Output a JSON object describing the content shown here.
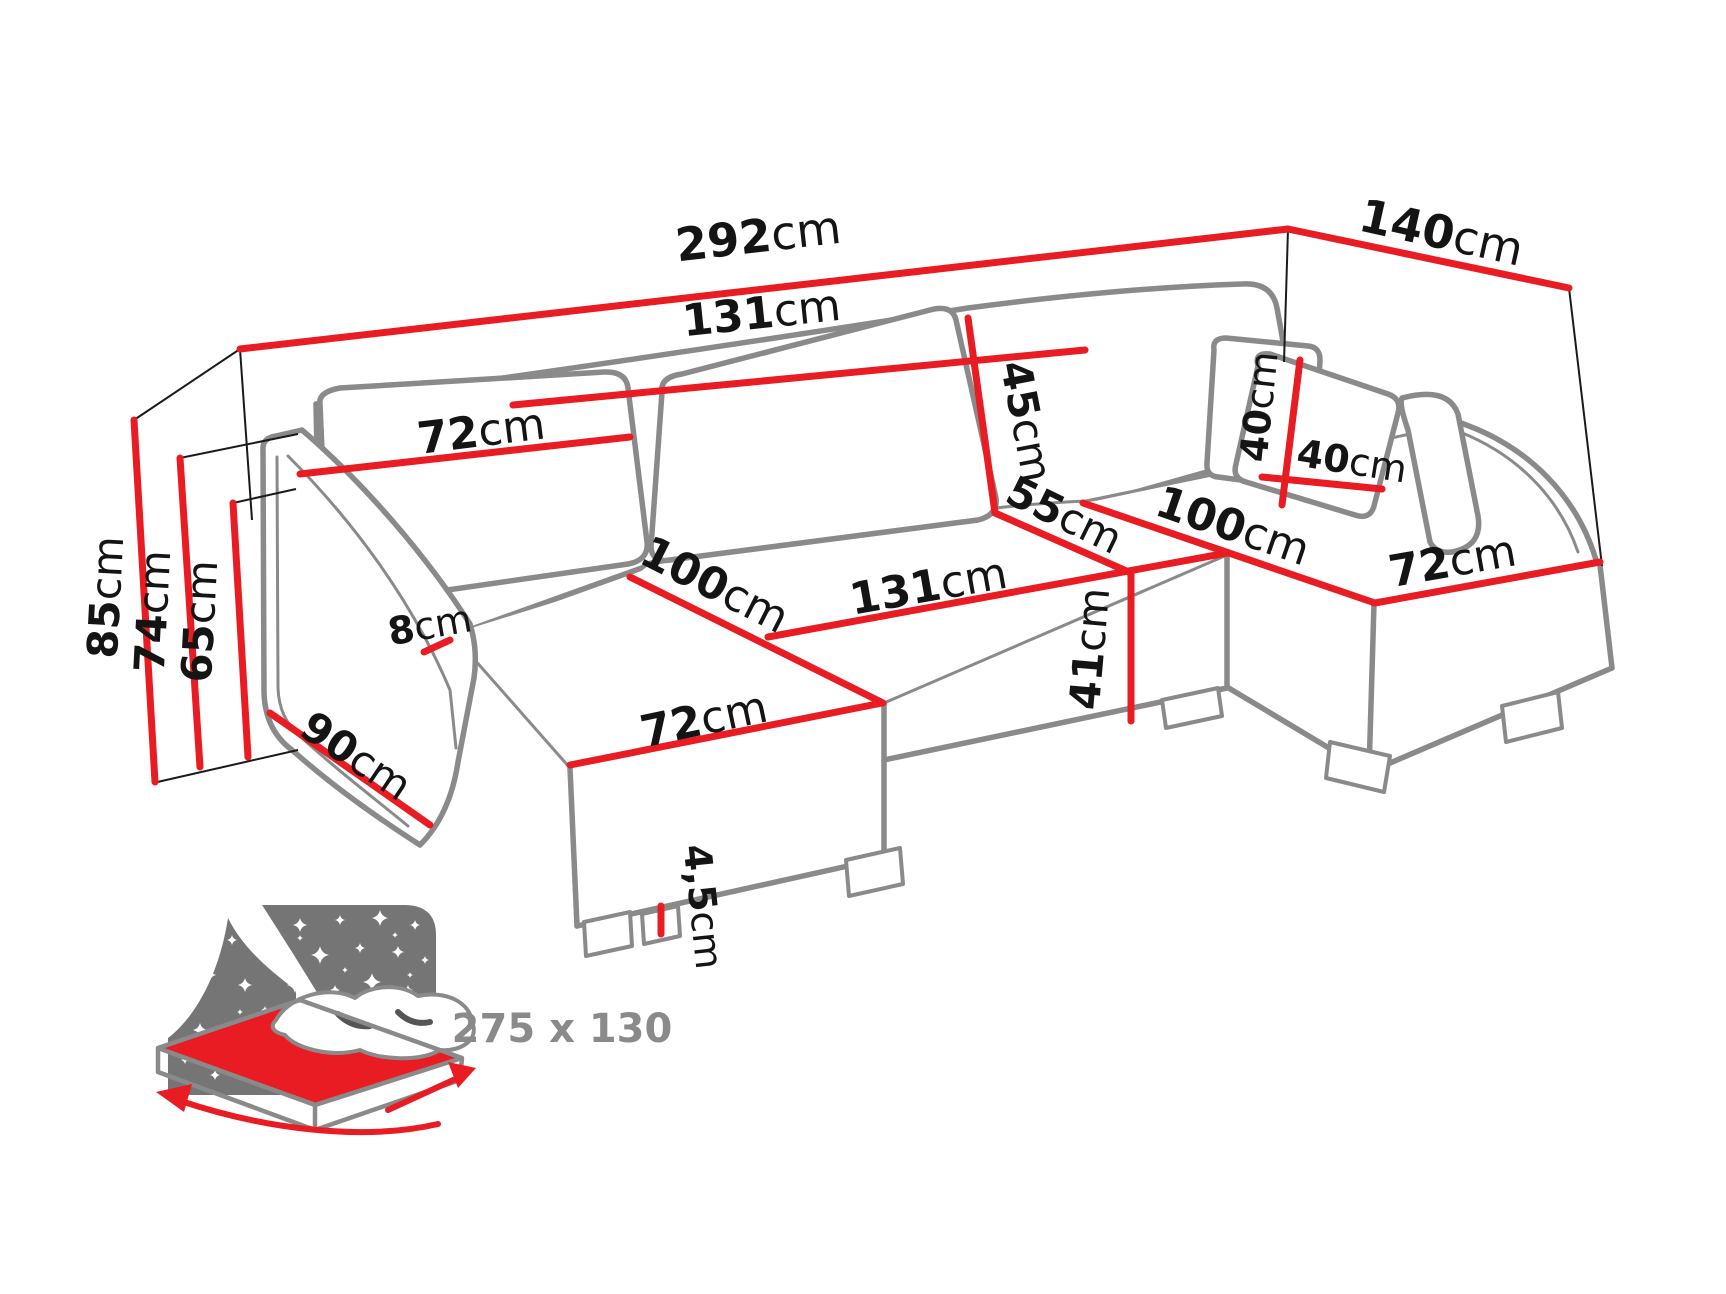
{
  "diagram": {
    "type": "sofa-dimension-diagram",
    "unit_system": "cm",
    "colors": {
      "dimension_line": "#e81c22",
      "sofa_outline": "#8a8a8a",
      "label_text": "#141414",
      "bed_icon_gray": "#757575",
      "bed_text_gray": "#8a8a8a",
      "background": "#ffffff"
    },
    "dims": {
      "total_width": {
        "num": "292",
        "unit": "cm"
      },
      "total_depth": {
        "num": "140",
        "unit": "cm"
      },
      "back_mid_width": {
        "num": "131",
        "unit": "cm"
      },
      "back_left_width": {
        "num": "72",
        "unit": "cm"
      },
      "back_cushion_height": {
        "num": "45",
        "unit": "cm"
      },
      "seat_depth": {
        "num": "55",
        "unit": "cm"
      },
      "seat_mid_width": {
        "num": "131",
        "unit": "cm"
      },
      "seat_height": {
        "num": "41",
        "unit": "cm"
      },
      "chaise_left_length": {
        "num": "100",
        "unit": "cm"
      },
      "chaise_left_width": {
        "num": "72",
        "unit": "cm"
      },
      "chaise_right_length": {
        "num": "100",
        "unit": "cm"
      },
      "chaise_right_width": {
        "num": "72",
        "unit": "cm"
      },
      "height_total": {
        "num": "85",
        "unit": "cm"
      },
      "height_backrest": {
        "num": "74",
        "unit": "cm"
      },
      "height_armrest": {
        "num": "65",
        "unit": "cm"
      },
      "armrest_width": {
        "num": "8",
        "unit": "cm"
      },
      "armrest_depth": {
        "num": "90",
        "unit": "cm"
      },
      "foot_height": {
        "num": "4,5",
        "unit": "cm"
      },
      "pillow_height": {
        "num": "40",
        "unit": "cm"
      },
      "pillow_width": {
        "num": "40",
        "unit": "cm"
      }
    }
  },
  "bed_icon": {
    "sleeping_area": "275 x 130",
    "stars": [
      [
        300,
        925,
        7
      ],
      [
        340,
        920,
        5
      ],
      [
        380,
        918,
        8
      ],
      [
        415,
        925,
        5
      ],
      [
        285,
        950,
        5
      ],
      [
        320,
        955,
        9
      ],
      [
        360,
        948,
        5
      ],
      [
        398,
        952,
        6
      ],
      [
        425,
        960,
        4
      ],
      [
        295,
        985,
        8
      ],
      [
        335,
        990,
        5
      ],
      [
        372,
        982,
        9
      ],
      [
        408,
        990,
        5
      ],
      [
        428,
        1005,
        6
      ],
      [
        310,
        1015,
        6
      ],
      [
        350,
        1012,
        5
      ],
      [
        388,
        1018,
        8
      ],
      [
        420,
        1032,
        5
      ],
      [
        285,
        1012,
        4
      ],
      [
        330,
        1038,
        6
      ],
      [
        368,
        1040,
        4
      ],
      [
        300,
        938,
        3
      ],
      [
        410,
        975,
        3
      ],
      [
        345,
        970,
        3
      ],
      [
        395,
        935,
        3
      ],
      [
        275,
        935,
        4
      ],
      [
        232,
        940,
        5
      ],
      [
        210,
        975,
        6
      ],
      [
        185,
        1000,
        5
      ],
      [
        245,
        985,
        7
      ],
      [
        265,
        1010,
        4
      ],
      [
        200,
        1030,
        7
      ],
      [
        230,
        1050,
        5
      ],
      [
        260,
        1045,
        6
      ],
      [
        185,
        1060,
        4
      ],
      [
        215,
        1075,
        5
      ],
      [
        250,
        1078,
        4
      ],
      [
        275,
        1065,
        5
      ],
      [
        240,
        1012,
        3
      ],
      [
        195,
        1048,
        3
      ]
    ]
  }
}
